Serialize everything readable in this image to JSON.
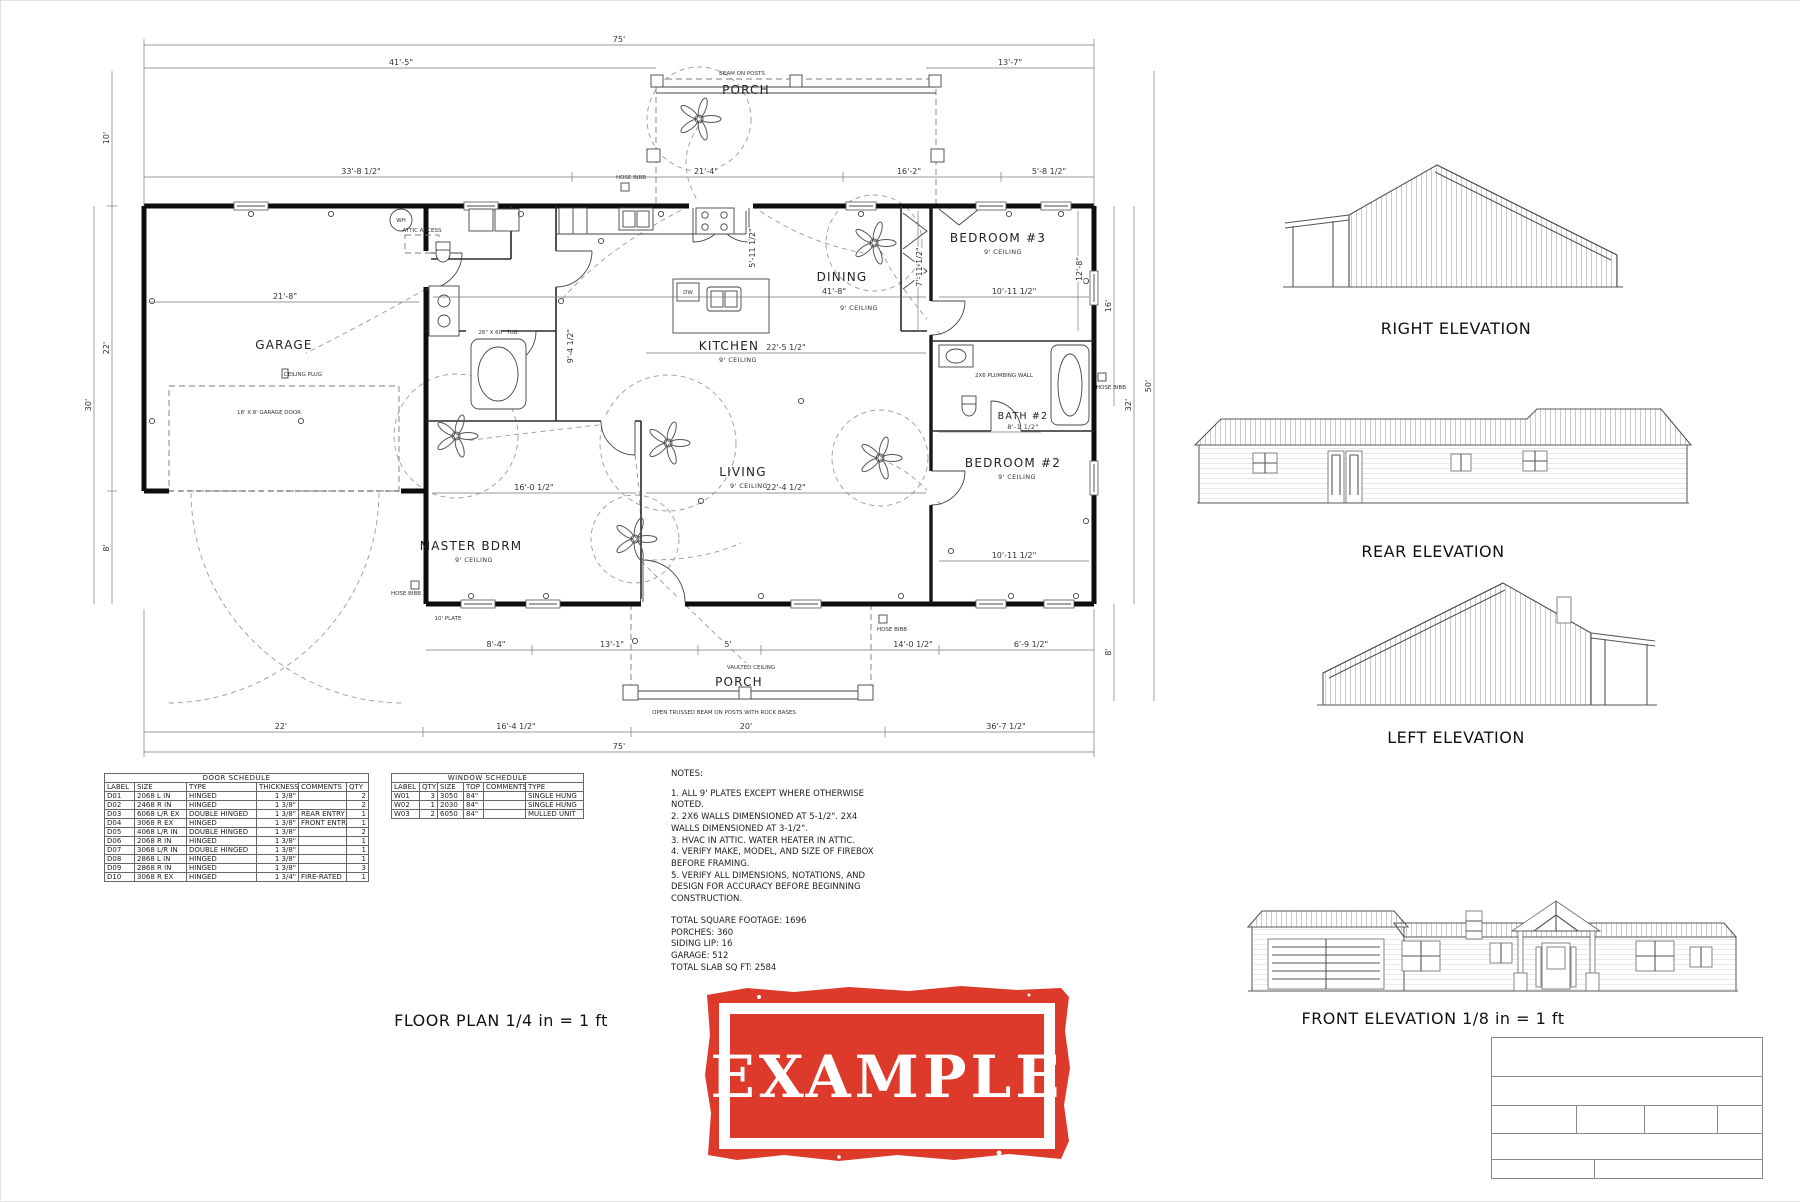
{
  "sheet": {
    "background": "#ffffff"
  },
  "floor_plan": {
    "caption": "FLOOR PLAN 1/4 in = 1 ft",
    "rooms": {
      "garage": "GARAGE",
      "master": "MASTER BDRM",
      "kitchen": "KITCHEN",
      "dining": "DINING",
      "living": "LIVING",
      "bedroom3": "BEDROOM #3",
      "bedroom2": "BEDROOM #2",
      "bath2": "BATH #2",
      "porch": "PORCH",
      "ceiling_9": "9' CEILING"
    },
    "annotations": {
      "beam_on_posts": "BEAM ON POSTS",
      "open_trussed": "OPEN TRUSSED BEAM ON POSTS WITH ROCK BASES",
      "vaulted_ceiling": "VAULTED CEILING",
      "garage_door": "18' X 8' GARAGE DOOR",
      "ceiling_plug": "CEILING PLUG",
      "attic_access": "ATTIC ACCESS",
      "wh": "WH",
      "dw": "DW",
      "hose_bibb": "HOSE BIBB",
      "plumbing_wall": "2X6 PLUMBING WALL",
      "plate": "10' PLATE",
      "tub": "26\" X 60\" TUB",
      "bath2_width": "8'-1 1/2\""
    },
    "dims": {
      "overall_top": "75'",
      "t1": "41'-5\"",
      "t2": "13'-7\"",
      "t3": "33'-8 1/2\"",
      "t4": "21'-4\"",
      "t5": "16'-2\"",
      "t6": "5'-8 1/2\"",
      "l1": "10'",
      "l2": "22'",
      "l3": "8'",
      "l4": "30'",
      "r1": "16'",
      "r2": "8'",
      "r3": "32'",
      "r4": "50'",
      "g1": "21'-8\"",
      "m1": "41'-8\"",
      "m2": "10'-11 1/2\"",
      "m3": "22'-5 1/2\"",
      "m4": "16'-0 1/2\"",
      "m5": "22'-4 1/2\"",
      "m6": "10'-11 1/2\"",
      "m7": "7'-11 1/2\"",
      "m8": "12'-8\"",
      "m9": "5'-11 1/2\"",
      "m10": "9'-4 1/2\"",
      "b1": "8'-4\"",
      "b2": "13'-1\"",
      "b3": "5'",
      "b4": "14'-0 1/2\"",
      "b5": "6'-9 1/2\"",
      "b6": "22'",
      "b7": "16'-4 1/2\"",
      "b8": "20'",
      "b9": "36'-7 1/2\"",
      "overall_bottom": "75'"
    }
  },
  "door_schedule": {
    "title": "DOOR SCHEDULE",
    "headers": [
      "LABEL",
      "SIZE",
      "TYPE",
      "THICKNESS",
      "COMMENTS",
      "QTY"
    ],
    "rows": [
      [
        "D01",
        "2068 L IN",
        "HINGED",
        "1 3/8\"",
        "",
        "2"
      ],
      [
        "D02",
        "2468 R IN",
        "HINGED",
        "1 3/8\"",
        "",
        "2"
      ],
      [
        "D03",
        "6068 L/R EX",
        "DOUBLE HINGED",
        "1 3/8\"",
        "REAR ENTRY",
        "1"
      ],
      [
        "D04",
        "3068 R EX",
        "HINGED",
        "1 3/8\"",
        "FRONT ENTRY",
        "1"
      ],
      [
        "D05",
        "4068 L/R IN",
        "DOUBLE HINGED",
        "1 3/8\"",
        "",
        "2"
      ],
      [
        "D06",
        "2068 R IN",
        "HINGED",
        "1 3/8\"",
        "",
        "1"
      ],
      [
        "D07",
        "3068 L/R IN",
        "DOUBLE HINGED",
        "1 3/8\"",
        "",
        "1"
      ],
      [
        "D08",
        "2868 L IN",
        "HINGED",
        "1 3/8\"",
        "",
        "1"
      ],
      [
        "D09",
        "2868 R IN",
        "HINGED",
        "1 3/8\"",
        "",
        "3"
      ],
      [
        "D10",
        "3068 R EX",
        "HINGED",
        "1 3/4\"",
        "FIRE-RATED",
        "1"
      ]
    ]
  },
  "window_schedule": {
    "title": "WINDOW SCHEDULE",
    "headers": [
      "LABEL",
      "QTY",
      "SIZE",
      "TOP",
      "COMMENTS",
      "TYPE"
    ],
    "rows": [
      [
        "W01",
        "3",
        "3050",
        "84\"",
        "",
        "SINGLE HUNG"
      ],
      [
        "W02",
        "1",
        "2030",
        "84\"",
        "",
        "SINGLE HUNG"
      ],
      [
        "W03",
        "2",
        "6050",
        "84\"",
        "",
        "MULLED UNIT"
      ]
    ]
  },
  "notes": {
    "title": "NOTES:",
    "items": [
      "1. ALL 9' PLATES EXCEPT WHERE OTHERWISE NOTED.",
      "2. 2X6 WALLS DIMENSIONED AT 5-1/2\". 2X4 WALLS DIMENSIONED AT 3-1/2\".",
      "3. HVAC IN ATTIC. WATER HEATER IN ATTIC.",
      "4. VERIFY MAKE, MODEL, AND SIZE OF FIREBOX BEFORE FRAMING.",
      "5. VERIFY ALL DIMENSIONS, NOTATIONS, AND DESIGN FOR ACCURACY BEFORE BEGINNING CONSTRUCTION."
    ],
    "totals": [
      "TOTAL SQUARE FOOTAGE: 1696",
      "PORCHES: 360",
      "SIDING LIP: 16",
      "GARAGE: 512",
      "TOTAL SLAB SQ FT: 2584"
    ]
  },
  "elevations": {
    "right": "RIGHT ELEVATION",
    "rear": "REAR ELEVATION",
    "left": "LEFT ELEVATION",
    "front": "FRONT ELEVATION 1/8 in = 1 ft"
  },
  "stamp": {
    "text": "EXAMPLE",
    "color": "#de3a2c"
  }
}
